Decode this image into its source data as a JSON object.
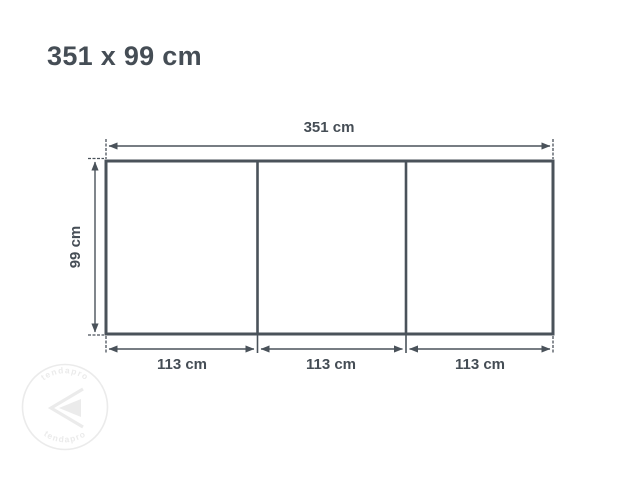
{
  "title": "351 x 99 cm",
  "colors": {
    "line": "#4a525a",
    "text": "#454d55",
    "watermark": "#ebebeb",
    "background": "#ffffff"
  },
  "diagram": {
    "type": "dimension-drawing",
    "object": "three-panel rectangle (awning/screen front view)",
    "total_width_cm": 351,
    "height_cm": 99,
    "panel_width_cm": 113,
    "panel_count": 3,
    "total_width_label": "351 cm",
    "height_label": "99 cm",
    "panel_labels": [
      "113 cm",
      "113 cm",
      "113 cm"
    ]
  },
  "watermark": {
    "text_top": "tendapro",
    "text_bottom": "tendapro"
  }
}
